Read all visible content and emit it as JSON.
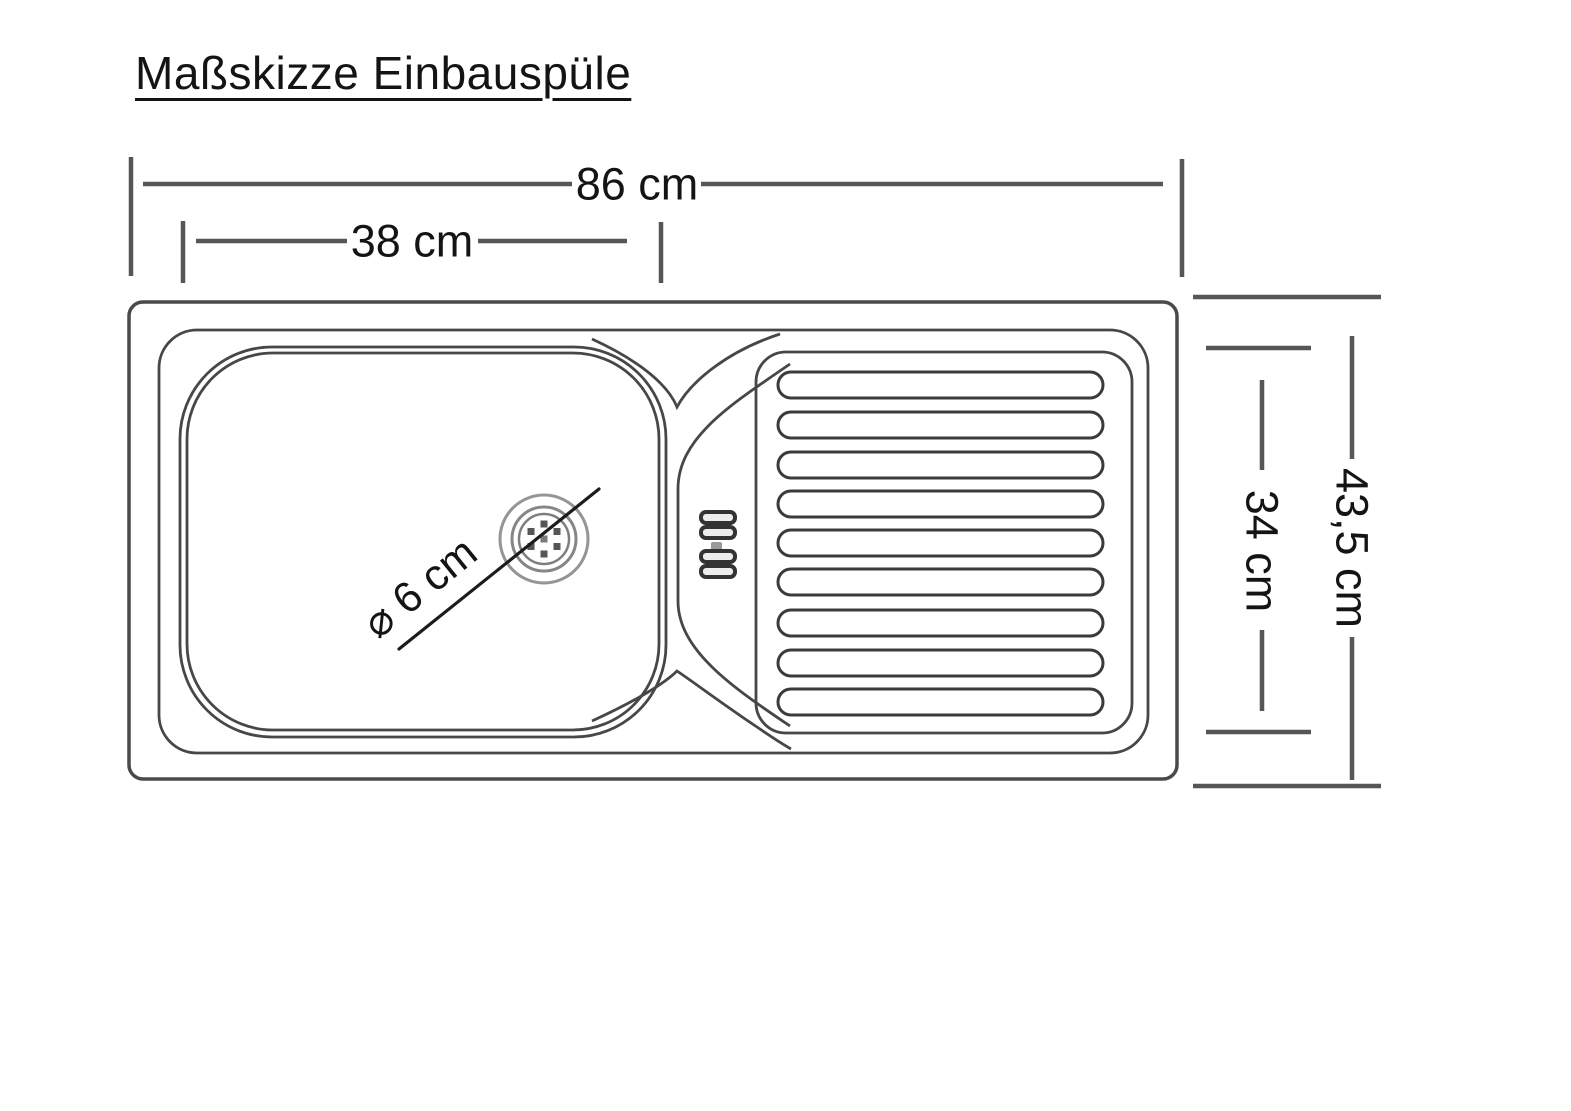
{
  "title": "Maßskizze Einbauspüle",
  "dimensions": {
    "total_width": "86 cm",
    "basin_width": "38 cm",
    "total_depth": "43,5 cm",
    "drainer_depth": "34 cm",
    "drain_diameter": "⌀ 6 cm"
  },
  "drawing": {
    "drainboard_slat_count": 9,
    "colors": {
      "background": "#ffffff",
      "outline": "#3f3f3f",
      "dimension_line": "#565656",
      "text": "#141414"
    }
  }
}
